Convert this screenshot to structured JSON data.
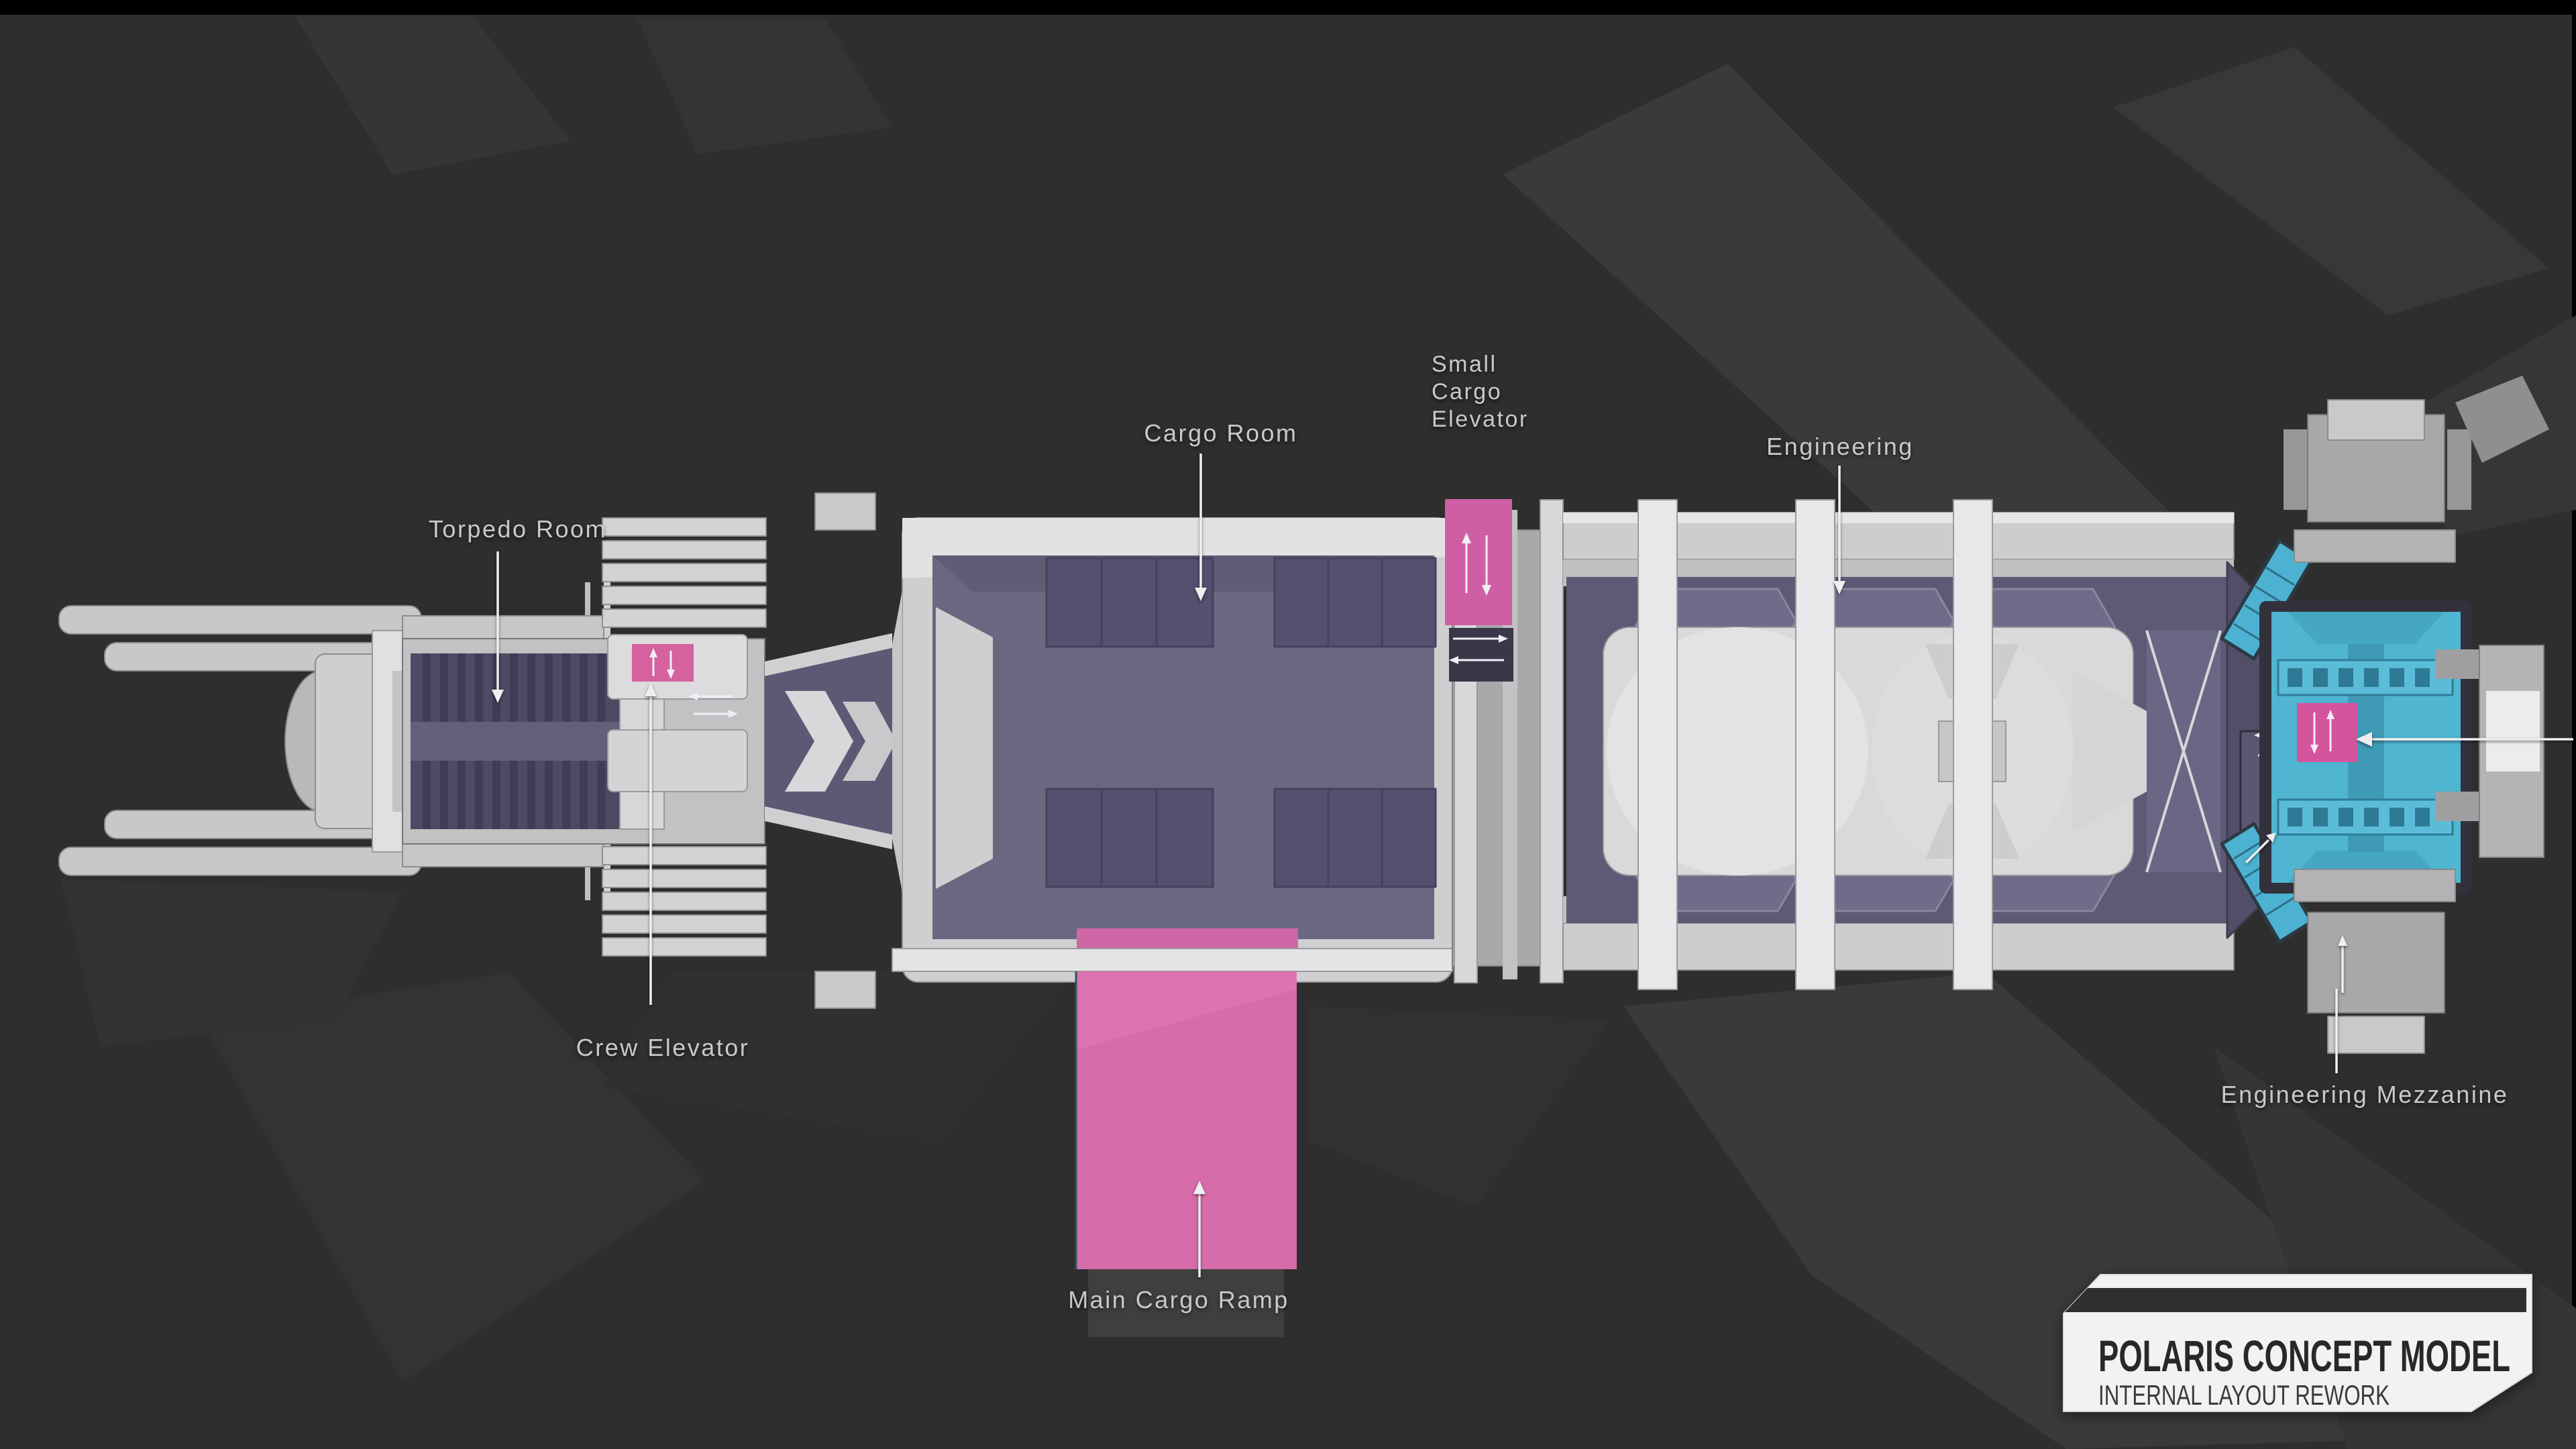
{
  "scene": {
    "description": "Top-down cutaway concept render of the Polaris capital ship with highlighted interior rooms",
    "background_color": "#2e2e2e",
    "top_bar_color": "#000000"
  },
  "colors": {
    "hull_light": "#cfcfd1",
    "hull_bright": "#e4e4e6",
    "room_purple": "#6a6780",
    "room_purple_dark": "#535070",
    "highlight_pink": "#d5619f",
    "ramp_pink": "#d76cab",
    "mezzanine_cyan": "#4fb5d1",
    "label_text": "#c9c9c9",
    "annotation_white": "#efefef"
  },
  "labels": {
    "torpedo_room": "Torpedo Room",
    "cargo_room": "Cargo Room",
    "small_cargo_elevator": {
      "lines": [
        "Small",
        "Cargo",
        "Elevator"
      ]
    },
    "engineering": "Engineering",
    "crew_elevator": "Crew Elevator",
    "main_cargo_ramp": "Main Cargo Ramp",
    "engineering_mezzanine": "Engineering Mezzanine"
  },
  "title_card": {
    "title": "POLARIS CONCEPT MODEL",
    "subtitle": "INTERNAL LAYOUT REWORK"
  }
}
